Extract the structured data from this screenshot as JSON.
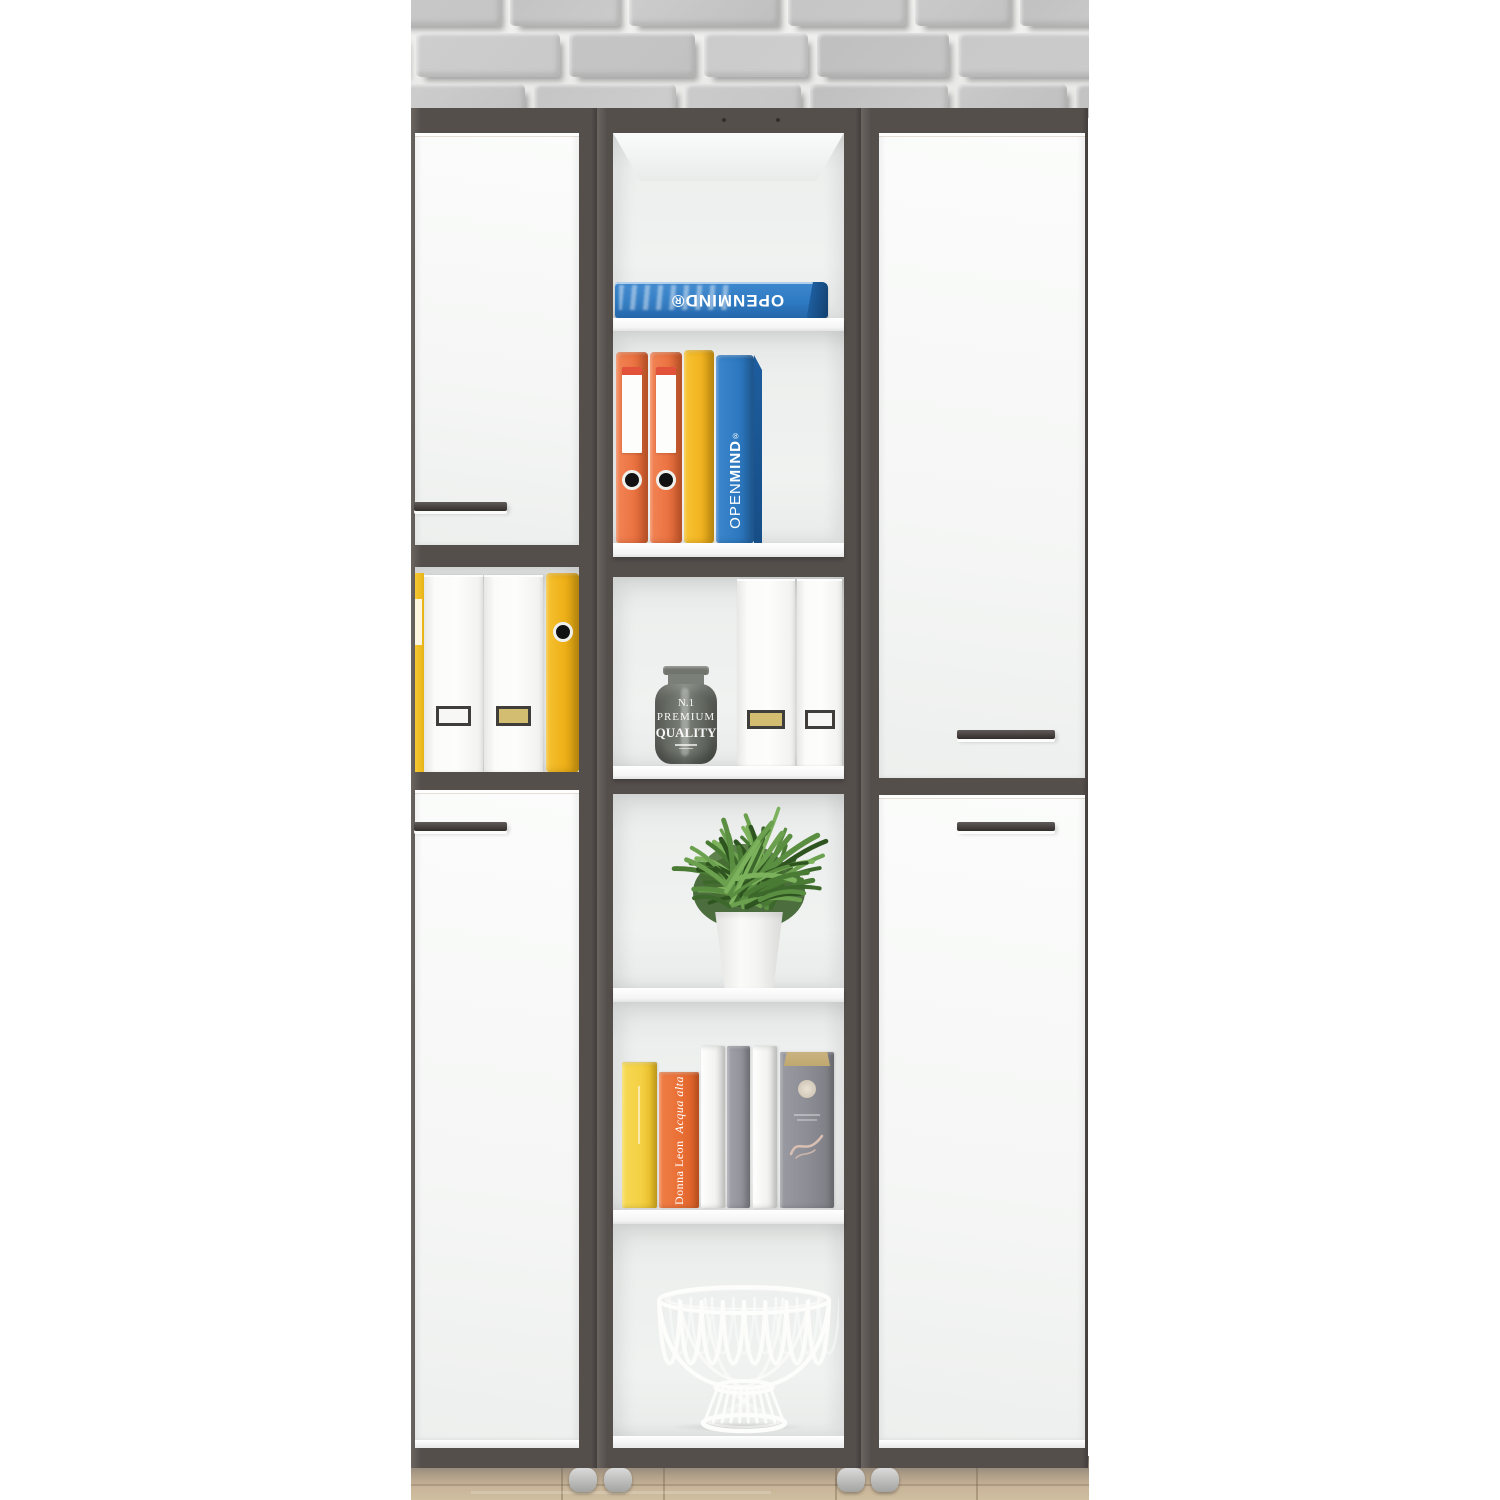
{
  "objects": {
    "wall": "gray painted brick wall",
    "floor": "light oak wood floor",
    "left_cabinet": "white office cabinet with two doors and open file shelf",
    "center_shelf": "narrow open shelving tower with six compartments",
    "right_cabinet": "tall white office cabinet with two doors",
    "shelf_contents": [
      "blue OPENMIND binder lying flat",
      "orange, yellow and blue lever-arch binders",
      "smoky glass jar and white magazine files",
      "green potted plant in white pot",
      "row of books",
      "white wire basket"
    ]
  },
  "texts": {
    "flat_binder_brand": "OPENMIND®",
    "spine_brand_open": "OPEN",
    "spine_brand_mind": "MIND",
    "spine_brand_reg": "®",
    "jar_no": "N.1",
    "jar_premium": "PREMIUM",
    "jar_quality": "QUALITY",
    "book_author": "Donna Leon",
    "book_title": "Acqua alta"
  },
  "colors": {
    "frame": "#554f4c",
    "frame_light": "#6b6562",
    "door": "#f7f8f7",
    "interior": "#edefee",
    "shelf": "#ffffff",
    "handle": "#474240",
    "handle_light": "#615c59",
    "feet": "#dadada",
    "brick": "#c6c6c6",
    "mortar": "#efefee",
    "floor_light": "#c9b599",
    "floor_dark": "#6e665c",
    "binder_orange": "#ec7544",
    "binder_orange_stripe": "#e2523a",
    "binder_yellow": "#f2b422",
    "binder_blue": "#2e7ac2",
    "binder_blue_dark": "#1d5d9e",
    "white_file": "#fbfbf9",
    "label_gold": "#d3bd70",
    "label_border": "#403e3a",
    "jar_glass": "#666b64",
    "pot": "#fafaf8",
    "plant_green": "#4a7b35",
    "book_yellow": "#f4d043",
    "book_orange": "#e96f35",
    "book_gray": "#93939b",
    "book_pages": "#c9b27e",
    "basket_wire": "#fdfdfc"
  }
}
